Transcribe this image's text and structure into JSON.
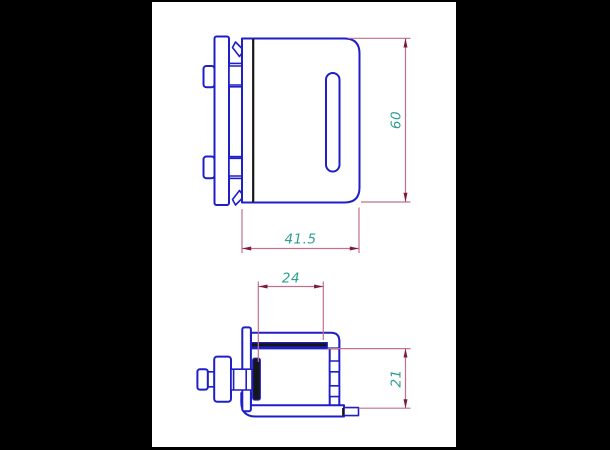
{
  "app": {
    "background_color": "#000000",
    "canvas_color": "#ffffff"
  },
  "palette": {
    "part_outline_blue": "#1f1fc8",
    "dimension_line_pink": "#c1718c",
    "dimension_arrow_maroon": "#7d1b3b",
    "dimension_text_teal": "#2f9e94",
    "section_line_dark": "#161616"
  },
  "views": {
    "front": {
      "label": "front-view-of-clamp-bracket",
      "dimensions": {
        "height": {
          "value": "60",
          "orientation": "vertical"
        },
        "width": {
          "value": "41.5",
          "orientation": "horizontal"
        }
      }
    },
    "side": {
      "label": "side-view-of-clamp-bracket",
      "dimensions": {
        "depth": {
          "value": "24",
          "orientation": "horizontal"
        },
        "leg_height": {
          "value": "21",
          "orientation": "vertical"
        }
      }
    }
  }
}
